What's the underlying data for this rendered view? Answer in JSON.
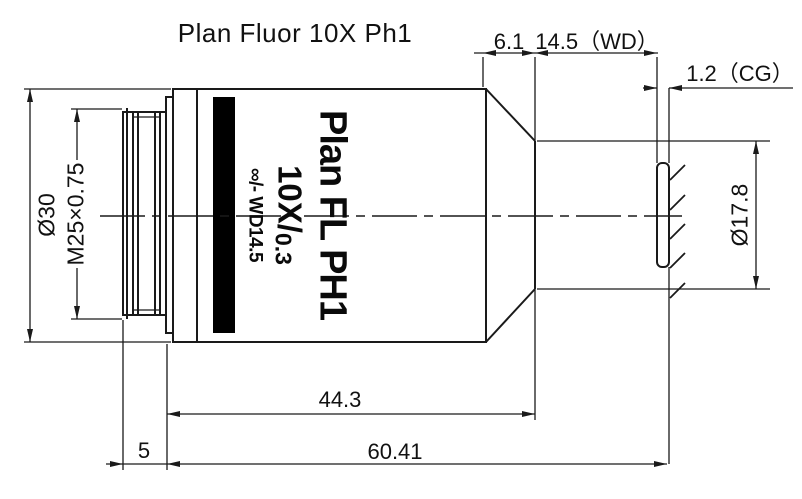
{
  "title": "Plan Fluor  10X  Ph1",
  "objective_marking": {
    "line1": "Plan FL PH1",
    "line2_big": "10X/",
    "line2_small": "0.3",
    "line3": "∞/- WD14.5"
  },
  "dimensions": {
    "taper_length": "6.1",
    "working_distance": "14.5（WD）",
    "cover_glass": "1.2（CG）",
    "body_diameter": "Ø30",
    "thread_spec": "M25×0.75",
    "front_diameter": "Ø17.8",
    "body_length": "44.3",
    "thread_length": "5",
    "total_length": "60.41"
  },
  "colors": {
    "line": "#1a1a1a",
    "band": "#000000",
    "background": "#ffffff"
  }
}
